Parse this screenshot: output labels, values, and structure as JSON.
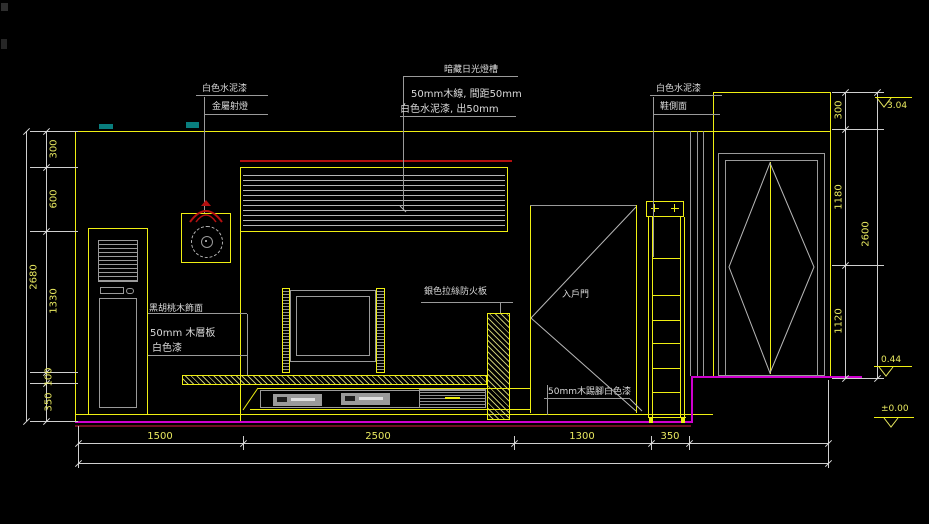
{
  "drawing": {
    "type": "interior-elevation-cad-drawing",
    "labels": {
      "left_wall_finish": "白色水泥漆",
      "metal_spotlight": "金屬射燈",
      "light_trough": "暗藏日光燈槽",
      "wood_slats": "50mm木線, 間距50mm",
      "slat_finish": "白色水泥漆, 出50mm",
      "right_wall_finish": "白色水泥漆",
      "shoe_cabinet_side": "鞋側面",
      "walnut_veneer": "黑胡桃木飾面",
      "wood_shelf": "50mm 木層板",
      "shelf_finish": "白色漆",
      "fireproof_board": "銀色拉絲防火板",
      "entry_door": "入戶門",
      "skirting": "50mm木踢腳白色漆"
    },
    "dimensions": {
      "left": [
        "300",
        "600",
        "1330",
        "100",
        "350"
      ],
      "left_overall": "2680",
      "right": [
        "300",
        "1180",
        "1120"
      ],
      "right_overall": "2600",
      "bottom": [
        "1500",
        "2500",
        "1300",
        "350"
      ],
      "elevation_top": "3.04",
      "elevation_entry": "0.44",
      "elevation_floor": "±0.00"
    },
    "colors": {
      "background": "#000000",
      "line_primary_yellow": "#efef12",
      "line_secondary_gray": "#9a9a9a",
      "dimension_text_yellow": "#e8e85f",
      "annotation_text": "#d9d9d9",
      "accent_red": "#b41010",
      "floor_magenta": "#cf00cf",
      "floor_maroon": "#6e1020",
      "artifact_cyan": "#0b9e9e"
    }
  }
}
